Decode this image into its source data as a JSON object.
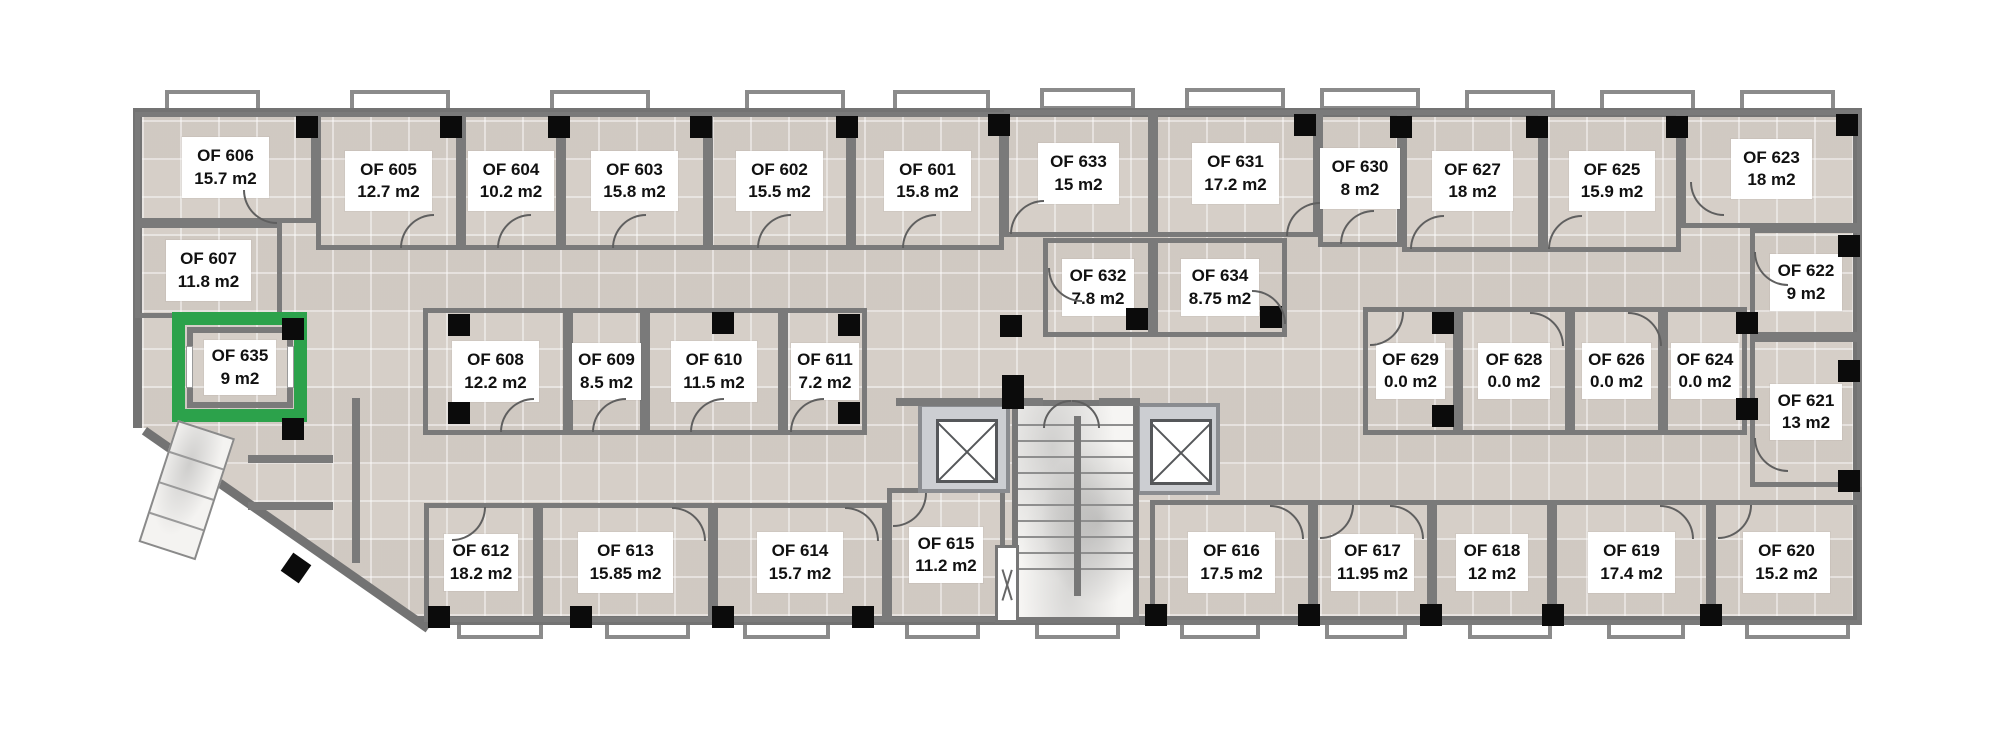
{
  "plan": {
    "type": "office-floor-plan",
    "highlighted_room": "OF 635",
    "colors": {
      "highlight_green": "#2ca24b",
      "wall_gray": "#7a7a7a",
      "floor_tile": "#d6cfc8",
      "column_black": "#0b0b0b",
      "label_bg": "#ffffff"
    },
    "rooms": [
      {
        "id": "OF 601",
        "area": "15.8 m2"
      },
      {
        "id": "OF 602",
        "area": "15.5 m2"
      },
      {
        "id": "OF 603",
        "area": "15.8 m2"
      },
      {
        "id": "OF 604",
        "area": "10.2 m2"
      },
      {
        "id": "OF 605",
        "area": "12.7 m2"
      },
      {
        "id": "OF 606",
        "area": "15.7 m2"
      },
      {
        "id": "OF 607",
        "area": "11.8 m2"
      },
      {
        "id": "OF 608",
        "area": "12.2 m2"
      },
      {
        "id": "OF 609",
        "area": "8.5 m2"
      },
      {
        "id": "OF 610",
        "area": "11.5 m2"
      },
      {
        "id": "OF 611",
        "area": "7.2 m2"
      },
      {
        "id": "OF 612",
        "area": "18.2 m2"
      },
      {
        "id": "OF 613",
        "area": "15.85 m2"
      },
      {
        "id": "OF 614",
        "area": "15.7 m2"
      },
      {
        "id": "OF 615",
        "area": "11.2 m2"
      },
      {
        "id": "OF 616",
        "area": "17.5 m2"
      },
      {
        "id": "OF 617",
        "area": "11.95 m2"
      },
      {
        "id": "OF 618",
        "area": "12 m2"
      },
      {
        "id": "OF 619",
        "area": "17.4 m2"
      },
      {
        "id": "OF 620",
        "area": "15.2 m2"
      },
      {
        "id": "OF 621",
        "area": "13 m2"
      },
      {
        "id": "OF 622",
        "area": "9 m2"
      },
      {
        "id": "OF 623",
        "area": "18 m2"
      },
      {
        "id": "OF 624",
        "area": "0.0 m2"
      },
      {
        "id": "OF 625",
        "area": "15.9 m2"
      },
      {
        "id": "OF 626",
        "area": "0.0 m2"
      },
      {
        "id": "OF 627",
        "area": "18 m2"
      },
      {
        "id": "OF 628",
        "area": "0.0 m2"
      },
      {
        "id": "OF 629",
        "area": "0.0 m2"
      },
      {
        "id": "OF 630",
        "area": "8 m2"
      },
      {
        "id": "OF 631",
        "area": "17.2 m2"
      },
      {
        "id": "OF 632",
        "area": "7.8 m2"
      },
      {
        "id": "OF 633",
        "area": "15 m2"
      },
      {
        "id": "OF 634",
        "area": "8.75 m2"
      },
      {
        "id": "OF 635",
        "area": "9 m2"
      }
    ]
  }
}
